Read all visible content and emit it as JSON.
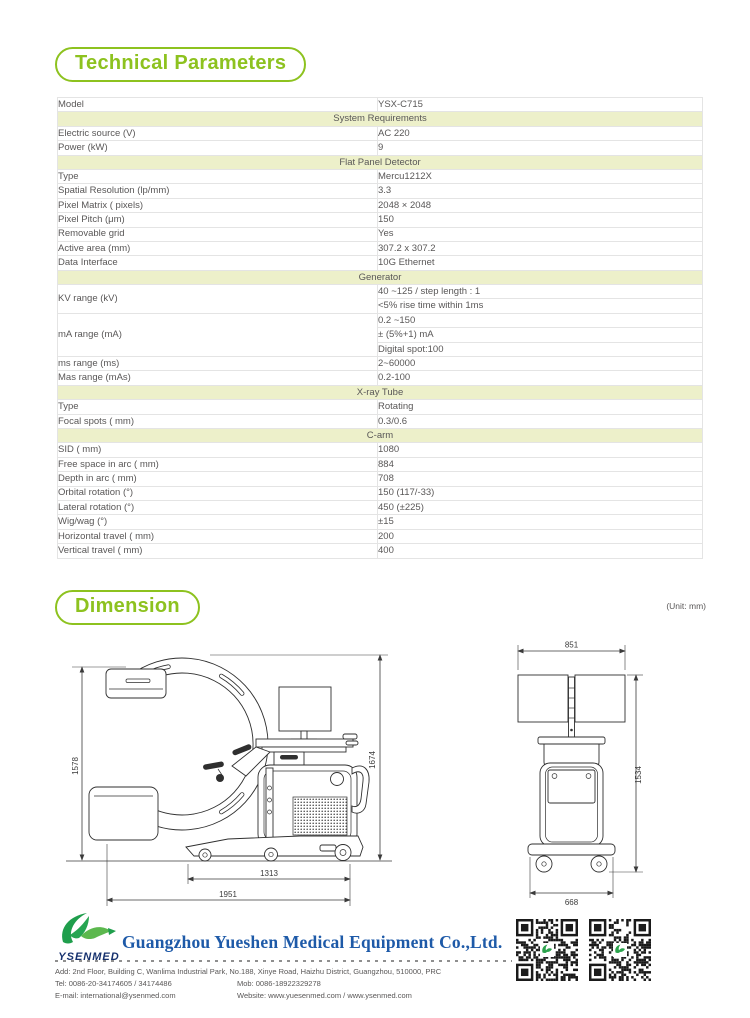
{
  "technical_section": {
    "title": "Technical Parameters"
  },
  "dimension_section": {
    "title": "Dimension",
    "unit_note": "(Unit: mm)"
  },
  "spec_table": {
    "rows": [
      {
        "kind": "data",
        "label": "Model",
        "value": "YSX-C715",
        "shaded": false
      },
      {
        "kind": "section",
        "label": "System Requirements"
      },
      {
        "kind": "data",
        "label": "Electric source (V)",
        "value": "AC 220",
        "shaded": false
      },
      {
        "kind": "data",
        "label": "Power (kW)",
        "value": "9",
        "shaded": true
      },
      {
        "kind": "section",
        "label": "Flat Panel Detector"
      },
      {
        "kind": "data",
        "label": "Type",
        "value": "Mercu1212X",
        "shaded": false
      },
      {
        "kind": "data",
        "label": "Spatial Resolution (lp/mm)",
        "value": "3.3",
        "shaded": true
      },
      {
        "kind": "data",
        "label": "Pixel Matrix ( pixels)",
        "value": "2048 × 2048",
        "shaded": false
      },
      {
        "kind": "data",
        "label": "Pixel Pitch (μm)",
        "value": "150",
        "shaded": true
      },
      {
        "kind": "data",
        "label": "Removable grid",
        "value": "Yes",
        "shaded": false
      },
      {
        "kind": "data",
        "label": "Active area (mm)",
        "value": "307.2 x 307.2",
        "shaded": true
      },
      {
        "kind": "data",
        "label": "Data Interface",
        "value": "10G Ethernet",
        "shaded": false
      },
      {
        "kind": "section",
        "label": "Generator"
      },
      {
        "kind": "group",
        "label": "KV range (kV)",
        "label_shaded": true,
        "values": [
          {
            "text": "40 ~125 / step length : 1",
            "shaded": true
          },
          {
            "text": "<5% rise time within 1ms",
            "shaded": false
          }
        ]
      },
      {
        "kind": "group",
        "label": "mA range (mA)",
        "label_shaded": false,
        "values": [
          {
            "text": "0.2 ~150",
            "shaded": false
          },
          {
            "text": "± (5%+1) mA",
            "shaded": true
          },
          {
            "text": "Digital spot:100",
            "shaded": false
          }
        ]
      },
      {
        "kind": "data",
        "label": "ms range (ms)",
        "value": "2~60000",
        "shaded": true
      },
      {
        "kind": "data",
        "label": "Mas range (mAs)",
        "value": "0.2-100",
        "shaded": false
      },
      {
        "kind": "section",
        "label": "X-ray Tube"
      },
      {
        "kind": "data",
        "label": "Type",
        "value": "Rotating",
        "shaded": false
      },
      {
        "kind": "data",
        "label": "Focal spots ( mm)",
        "value": "0.3/0.6",
        "shaded": true
      },
      {
        "kind": "section",
        "label": "C-arm"
      },
      {
        "kind": "data",
        "label": "SID ( mm)",
        "value": "1080",
        "shaded": true
      },
      {
        "kind": "data",
        "label": "Free space in arc ( mm)",
        "value": "884",
        "shaded": false
      },
      {
        "kind": "data",
        "label": "Depth in arc ( mm)",
        "value": "708",
        "shaded": true
      },
      {
        "kind": "data",
        "label": "Orbital rotation (°)",
        "value": "150 (117/-33)",
        "shaded": false
      },
      {
        "kind": "data",
        "label": "Lateral rotation (°)",
        "value": "450 (±225)",
        "shaded": true
      },
      {
        "kind": "data",
        "label": "Wig/wag (°)",
        "value": "±15",
        "shaded": false
      },
      {
        "kind": "data",
        "label": "Horizontal travel ( mm)",
        "value": "200",
        "shaded": true
      },
      {
        "kind": "data",
        "label": "Vertical travel ( mm)",
        "value": "400",
        "shaded": false
      }
    ]
  },
  "drawings": {
    "side_view": {
      "left_height": "1578",
      "right_height": "1674",
      "inner_width": "1313",
      "total_width": "1951"
    },
    "front_view": {
      "top_width": "851",
      "right_height": "1534",
      "bottom_width": "668"
    }
  },
  "footer": {
    "logo_text": "YSENMED",
    "company_name": "Guangzhou Yueshen Medical Equipment Co.,Ltd.",
    "address": "Add: 2nd Floor, Building C, Wanlima Industrial Park, No.188, Xinye Road, Haizhu District, Guangzhou, 510000, PRC",
    "tel": "Tel: 0086-20-34174605 / 34174486",
    "mob": "Mob: 0086-18922329278",
    "email": "E-mail: international@ysenmed.com",
    "website": "Website: www.yuesenmed.com / www.ysenmed.com"
  },
  "icons": {
    "logo": "ysenmed-bird-logo",
    "qr_left": "qr-code",
    "qr_right": "qr-code"
  },
  "colors": {
    "accent_green": "#8dc21f",
    "section_header_bg": "#edf0ca",
    "shaded_row_bg": "#efefef",
    "text_gray": "#595757",
    "company_blue": "#1e5aa8",
    "logo_green": "#2ca34d"
  }
}
